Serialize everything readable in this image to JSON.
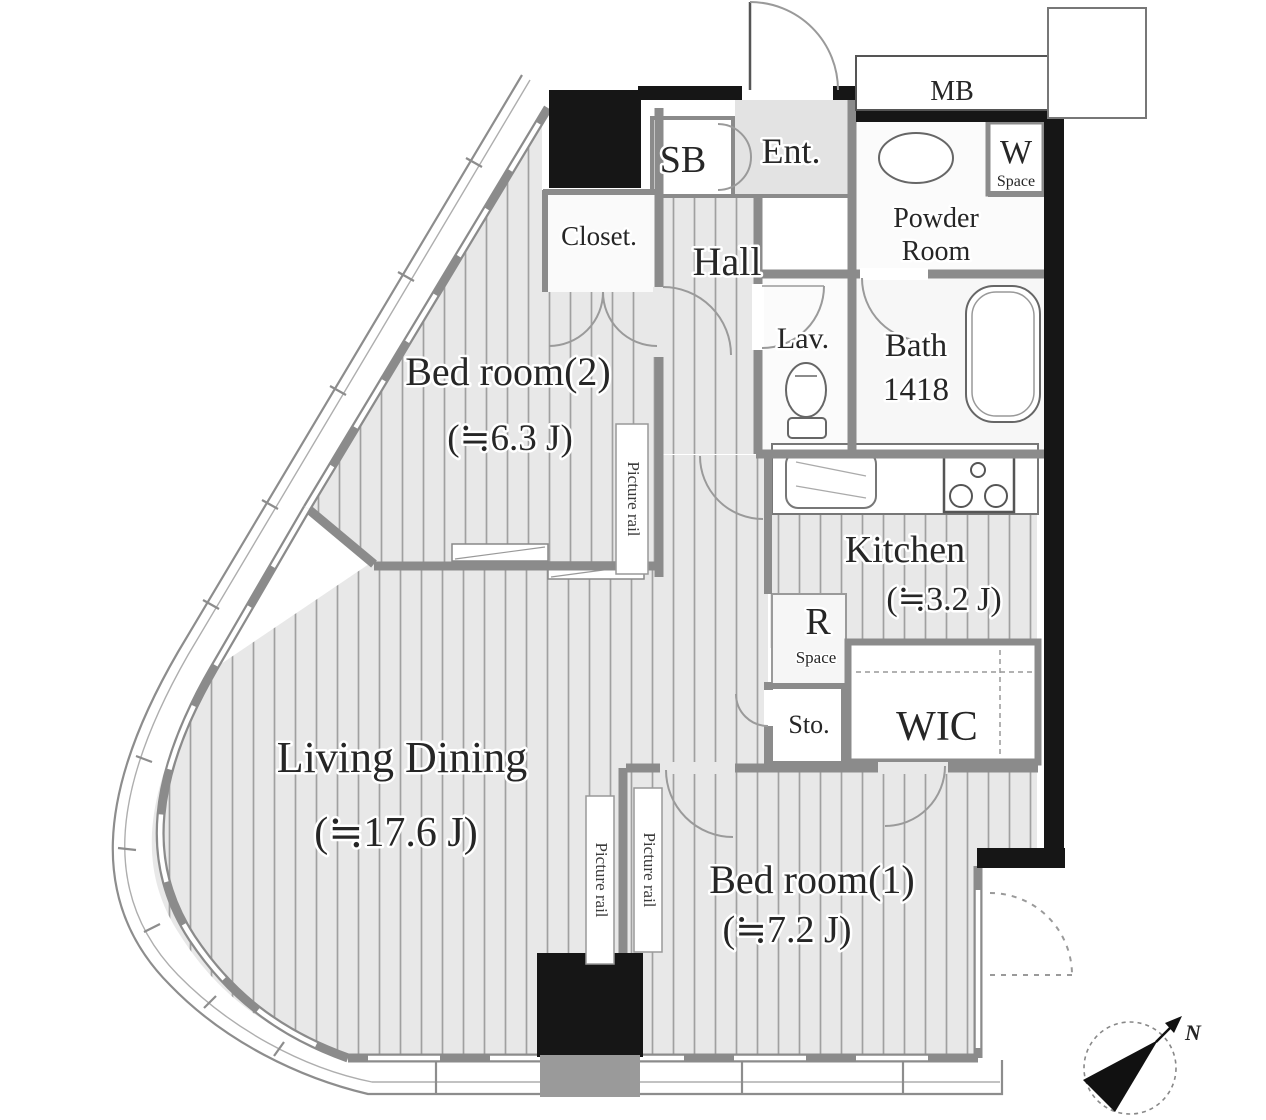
{
  "plan": {
    "rooms": {
      "bedroom2": {
        "name": "Bed room(2)",
        "size": "(≒6.3 J)"
      },
      "living": {
        "name": "Living Dining",
        "size": "(≒17.6 J)"
      },
      "bedroom1": {
        "name": "Bed room(1)",
        "size": "(≒7.2 J)"
      },
      "kitchen": {
        "name": "Kitchen",
        "size": "(≒3.2 J)"
      },
      "hall": {
        "name": "Hall"
      },
      "entrance": {
        "name": "Ent."
      },
      "shoe_box": {
        "name": "SB"
      },
      "closet": {
        "name": "Closet."
      },
      "powder_room": {
        "line1": "Powder",
        "line2": "Room"
      },
      "washer_space": {
        "letter": "W",
        "word": "Space"
      },
      "lavatory": {
        "name": "Lav."
      },
      "bath": {
        "name": "Bath",
        "size": "1418"
      },
      "refrigerator_space": {
        "letter": "R",
        "word": "Space"
      },
      "storage": {
        "name": "Sto."
      },
      "wic": {
        "name": "WIC"
      },
      "meter_box": {
        "name": "MB"
      }
    },
    "labels": {
      "picture_rail": "Picture rail"
    },
    "compass": {
      "north": "N"
    },
    "colors": {
      "wall_black": "#161616",
      "wall_gray": "#8b8b8b",
      "floor_stripe_bg": "#e8e8e8",
      "floor_stripe_line": "#a0a0a0",
      "text": "#262626"
    }
  }
}
